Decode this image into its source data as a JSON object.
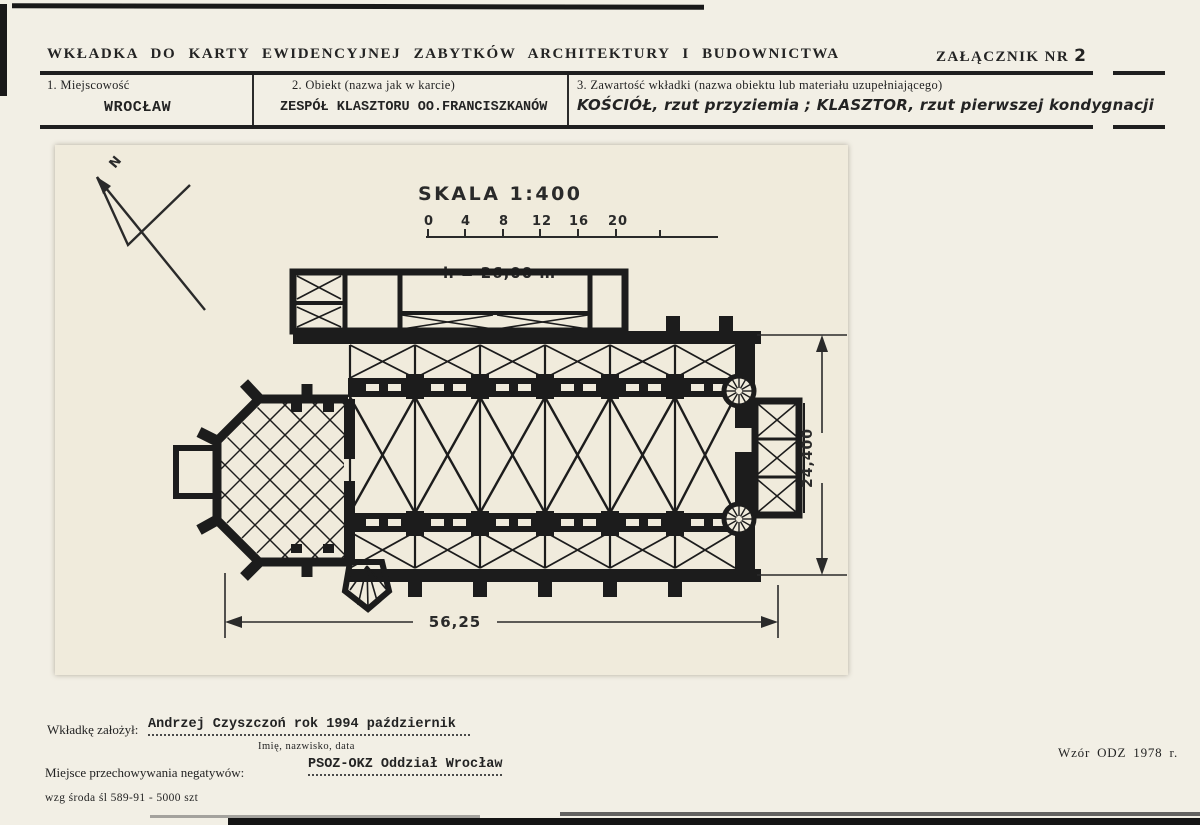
{
  "page": {
    "title": "WKŁADKA DO KARTY EWIDENCYJNEJ ZABYTKÓW ARCHITEKTURY I BUDOWNICTWA",
    "attachment_label": "ZAŁĄCZNIK NR",
    "attachment_number": "2"
  },
  "fields": {
    "f1_label": "1. Miejscowość",
    "f1_value": "WROCŁAW",
    "f2_label": "2. Obiekt (nazwa jak w karcie)",
    "f2_value": "ZESPÓŁ KLASZTORU OO.FRANCISZKANÓW",
    "f3_label": "3. Zawartość wkładki (nazwa obiektu lub materiału uzupełniającego)",
    "f3_value": "KOŚCIÓŁ, rzut przyziemia ; KLASZTOR, rzut pierwszej kondygnacji"
  },
  "drawing": {
    "north_label": "N",
    "scale_title": "SKALA 1:400",
    "scale_ticks": [
      "0",
      "4",
      "8",
      "12",
      "16",
      "20"
    ],
    "height_note": "h = 26,00 m",
    "dim_width": "56,25",
    "dim_height": "24,400"
  },
  "footer": {
    "founder_label": "Wkładkę założył:",
    "founder_value": "Andrzej Czyszczoń rok 1994 październik",
    "founder_sub": "Imię, nazwisko, data",
    "negatives_label": "Miejsce przechowywania negatywów:",
    "negatives_value": "PSOZ-OKZ Oddział Wrocław",
    "print_note": "wzg środa śl 589-91 - 5000 szt",
    "form_note": "Wzór ODZ 1978 r."
  }
}
